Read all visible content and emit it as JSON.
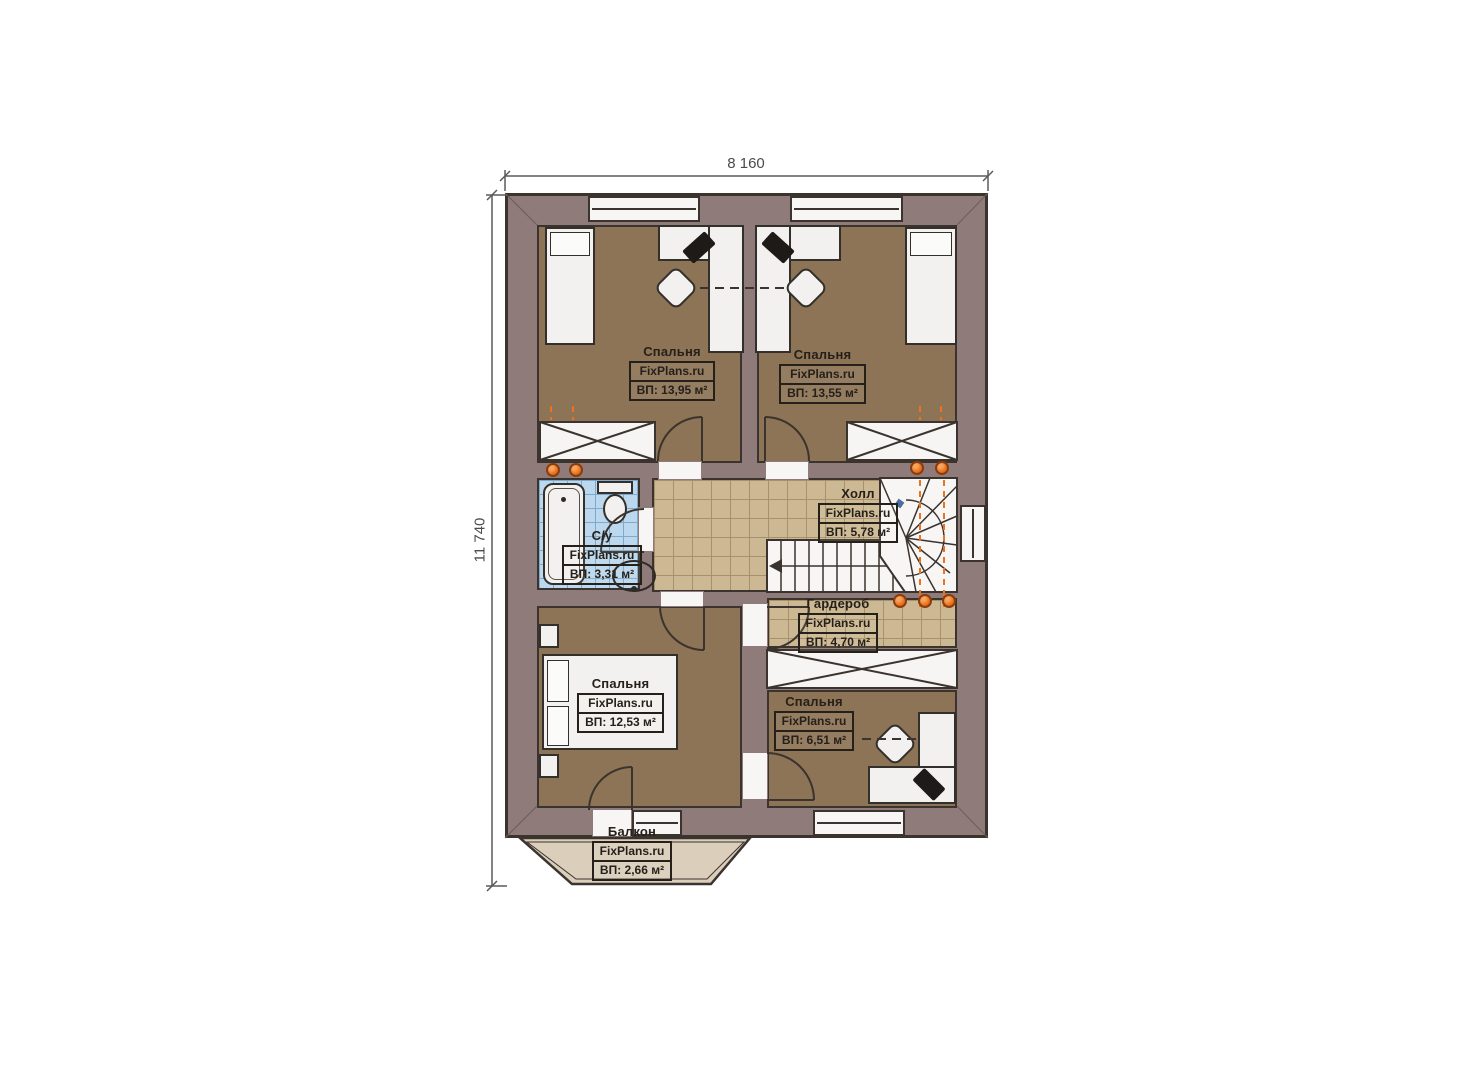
{
  "plan_title": "floor-plan-second-level",
  "dimensions": {
    "top": "8 160",
    "left": "11 740"
  },
  "brand": "FixPlans.ru",
  "rooms": {
    "bedroom_tl": {
      "name": "Спальня",
      "brand": "FixPlans.ru",
      "area": "ВП: 13,95 м²"
    },
    "bedroom_tr": {
      "name": "Спальня",
      "brand": "FixPlans.ru",
      "area": "ВП: 13,55 м²"
    },
    "bathroom": {
      "name": "С/у",
      "brand": "FixPlans.ru",
      "area": "ВП: 3,31 м²"
    },
    "hall": {
      "name": "Холл",
      "brand": "FixPlans.ru",
      "area": "ВП: 5,78 м²"
    },
    "wardrobe": {
      "name": "Гардероб",
      "brand": "FixPlans.ru",
      "area": "ВП: 4,70 м²"
    },
    "bedroom_bl": {
      "name": "Спальня",
      "brand": "FixPlans.ru",
      "area": "ВП: 12,53 м²"
    },
    "bedroom_br": {
      "name": "Спальня",
      "brand": "FixPlans.ru",
      "area": "ВП: 6,51 м²"
    },
    "balcony": {
      "name": "Балкон",
      "brand": "FixPlans.ru",
      "area": "ВП: 2,66 м²"
    }
  },
  "colors": {
    "wall": "#8e7b7a",
    "outline": "#3b332d",
    "bedroom_floor": "#8d7456",
    "hall_tile": "#ccb893",
    "bath_tile": "#bcd8ee",
    "balcony_floor": "#dbcfbc",
    "accent_orange": "#e8741f",
    "marker_blue": "#4a6fa5"
  }
}
